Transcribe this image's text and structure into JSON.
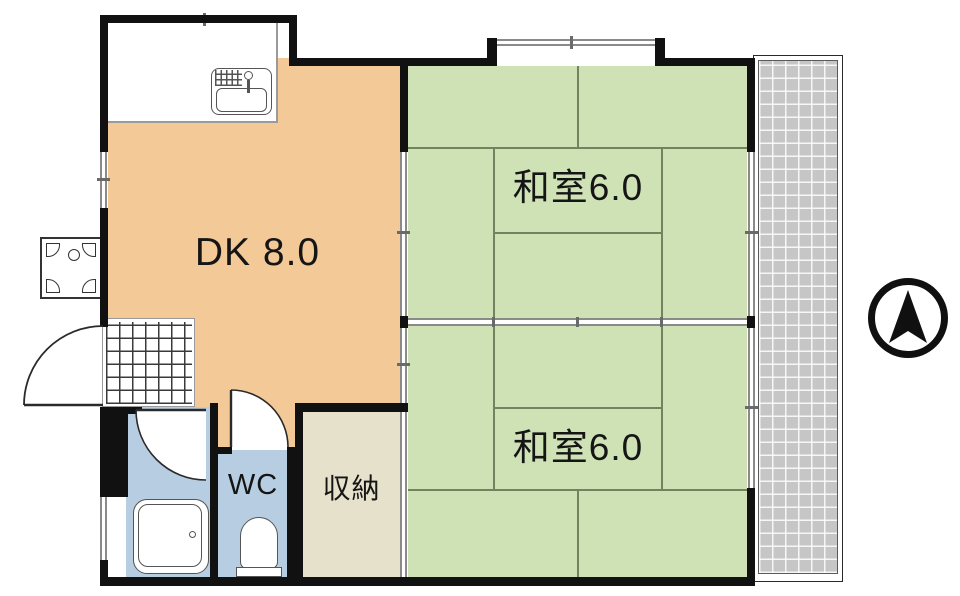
{
  "plan": {
    "rooms": {
      "dk": {
        "label": "DK 8.0"
      },
      "washitsu_top": {
        "label": "和室6.0"
      },
      "washitsu_bottom": {
        "label": "和室6.0"
      },
      "wc": {
        "label": "WC"
      },
      "storage": {
        "label": "収納"
      }
    },
    "icons": {
      "north_arrow": "north-arrow",
      "kitchen_sink": "kitchen-sink",
      "bathtub": "bathtub",
      "toilet": "toilet",
      "washer_pan": "washing-machine-pan",
      "entrance_tile": "genkan-tile-grid",
      "balcony": "balcony-deck",
      "doors": [
        "entry-swing-door",
        "bathroom-swing-door",
        "wc-swing-door"
      ],
      "sliding_doors": [
        "fusuma-dk-top-room",
        "fusuma-between-rooms",
        "fusuma-dk-bottom-room",
        "fusuma-storage"
      ]
    },
    "colors": {
      "wall": "#111111",
      "dk_fill": "#f3c997",
      "tatami_fill": "#cfe2b6",
      "bath_fill": "#b7cee2",
      "storage_fill": "#e5e1ca",
      "balcony_fill": "#c6c6c6",
      "tatami_line": "#73825f",
      "window_line": "#8a8a8a",
      "fixture_line": "#555555"
    }
  }
}
